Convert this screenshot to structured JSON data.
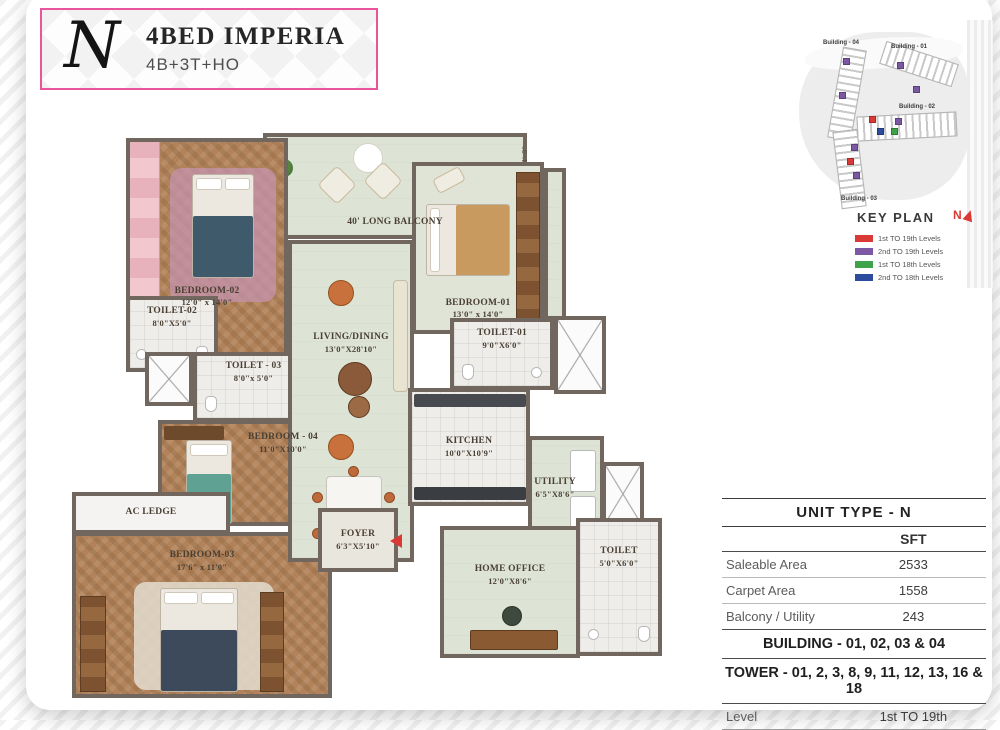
{
  "title_block": {
    "logo": "N",
    "title": "4BED IMPERIA",
    "subtitle": "4B+3T+HO"
  },
  "key_plan": {
    "heading": "KEY PLAN",
    "compass": "N",
    "buildings": {
      "b04": "Building - 04",
      "b01": "Building - 01",
      "b02": "Building - 02",
      "b03": "Building - 03"
    },
    "legend": [
      {
        "color": "#d93a35",
        "label": "1st TO 19th Levels"
      },
      {
        "color": "#7b57a4",
        "label": "2nd TO 19th Levels"
      },
      {
        "color": "#3fa34b",
        "label": "1st TO 18th Levels"
      },
      {
        "color": "#2c4d9d",
        "label": "2nd TO 18th Levels"
      }
    ]
  },
  "unit_table": {
    "title": "UNIT TYPE - N",
    "unit_header": "SFT",
    "rows": [
      {
        "label": "Saleable Area",
        "value": "2533"
      },
      {
        "label": "Carpet Area",
        "value": "1558"
      },
      {
        "label": "Balcony / Utility",
        "value": "243"
      }
    ],
    "building_line": "BUILDING - 01, 02, 03 & 04",
    "tower_line": "TOWER - 01, 2, 3, 8, 9, 11, 12, 13, 16 & 18",
    "level_label": "Level",
    "level_value": "1st TO 19th"
  },
  "floor_plan": {
    "rooms": {
      "balcony": {
        "name": "40' LONG BALCONY"
      },
      "bedroom02": {
        "name": "BEDROOM-02",
        "dims": "12'0\" x 14'0\""
      },
      "toilet02": {
        "name": "TOILET-02",
        "dims": "8'0\"X5'0\""
      },
      "toilet03": {
        "name": "TOILET - 03",
        "dims": "8'0\"x 5'0\""
      },
      "bedroom04": {
        "name": "BEDROOM - 04",
        "dims": "11'0\"X10'0\""
      },
      "ac_ledge": {
        "name": "AC LEDGE"
      },
      "bedroom03": {
        "name": "BEDROOM-03",
        "dims": "17'6\" x 11'0\""
      },
      "living": {
        "name": "LIVING/DINING",
        "dims": "13'0\"X28'10\""
      },
      "foyer": {
        "name": "FOYER",
        "dims": "6'3\"X5'10\""
      },
      "bedroom01": {
        "name": "BEDROOM-01",
        "dims": "13'0\" x 14'0\""
      },
      "toilet01": {
        "name": "TOILET-01",
        "dims": "9'0\"X6'0\""
      },
      "kitchen": {
        "name": "KITCHEN",
        "dims": "10'0\"X10'9\""
      },
      "utility": {
        "name": "UTILITY",
        "dims": "6'5\"X8'6\""
      },
      "home_office": {
        "name": "HOME OFFICE",
        "dims": "12'0\"X8'6\""
      },
      "toilet_ho": {
        "name": "TOILET",
        "dims": "5'0\"X6'0\""
      }
    },
    "annotations": {
      "dim_left": "7'-3\"",
      "dim_right": "4'-3\""
    }
  }
}
